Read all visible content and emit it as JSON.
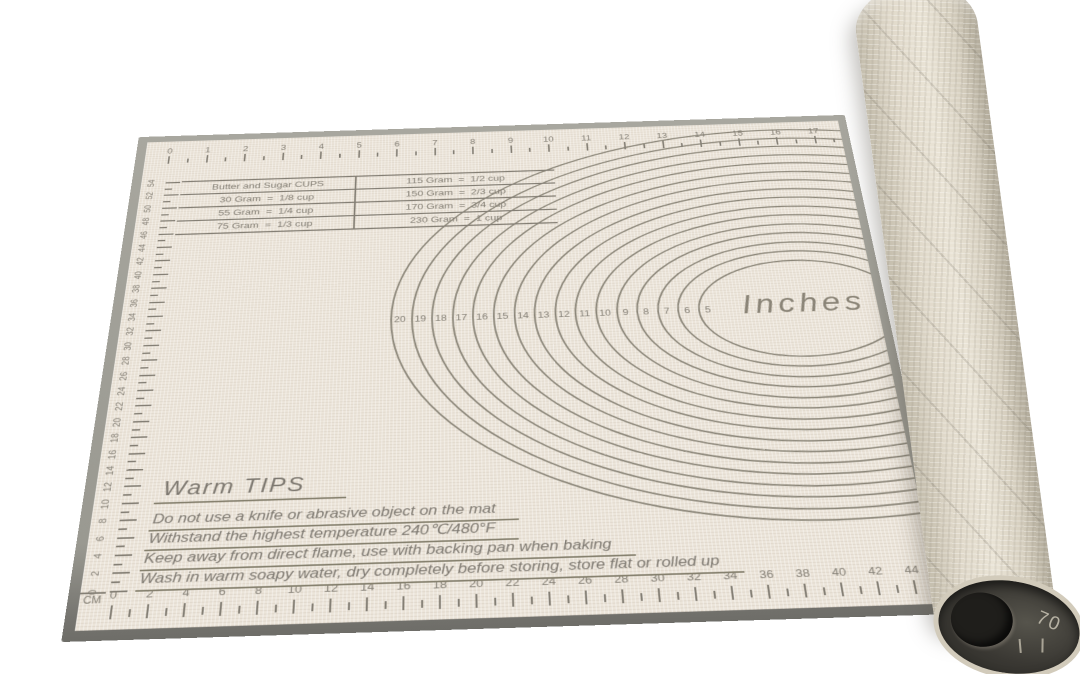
{
  "rulers": {
    "top_inches": [
      "0",
      "1",
      "2",
      "3",
      "4",
      "5",
      "6",
      "7",
      "8",
      "9",
      "10",
      "11",
      "12",
      "13",
      "14",
      "15",
      "16",
      "17",
      "18"
    ],
    "left_cm": [
      "54",
      "52",
      "50",
      "48",
      "46",
      "44",
      "42",
      "40",
      "38",
      "36",
      "34",
      "32",
      "30",
      "28",
      "26",
      "24",
      "22",
      "20",
      "18",
      "16",
      "14",
      "12",
      "10",
      "8",
      "6",
      "4",
      "2",
      "0"
    ],
    "bottom_cm": [
      "0",
      "2",
      "4",
      "6",
      "8",
      "10",
      "12",
      "14",
      "16",
      "18",
      "20",
      "22",
      "24",
      "26",
      "28",
      "30",
      "32",
      "34",
      "36",
      "38",
      "40",
      "42",
      "44",
      "46"
    ],
    "bottom_unit": "CM"
  },
  "conversion_table": {
    "left": [
      "Butter and Sugar CUPS",
      "30 Gram  =  1/8 cup",
      "55 Gram  =  1/4 cup",
      "75 Gram  =  1/3 cup"
    ],
    "right": [
      "115 Gram  =  1/2 cup",
      "150 Gram  =  2/3 cup",
      "170 Gram  =  3/4 cup",
      "230 Gram  =  1 cup"
    ]
  },
  "circles": {
    "numbers": [
      "20",
      "19",
      "18",
      "17",
      "16",
      "15",
      "14",
      "13",
      "12",
      "11",
      "10",
      "9",
      "8",
      "7",
      "6",
      "5"
    ],
    "label": "Inches"
  },
  "warm_tips": {
    "title": "Warm TIPS",
    "lines": [
      "Do not use a knife or abrasive object on the mat",
      "Withstand the highest temperature 240℃/480°F",
      "Keep away from direct flame, use with backing pan when baking",
      "Wash in warm soapy water, dry completely before storing, store flat or rolled up"
    ]
  },
  "roll": {
    "end_number": "70"
  },
  "colors": {
    "mat_surface": "#ece5da",
    "mat_edge": "#9a9991",
    "print": "#847f75",
    "circle_line": "#8b8679",
    "roll_mesh": "#ddd6c7",
    "roll_interior": "#35342f"
  }
}
